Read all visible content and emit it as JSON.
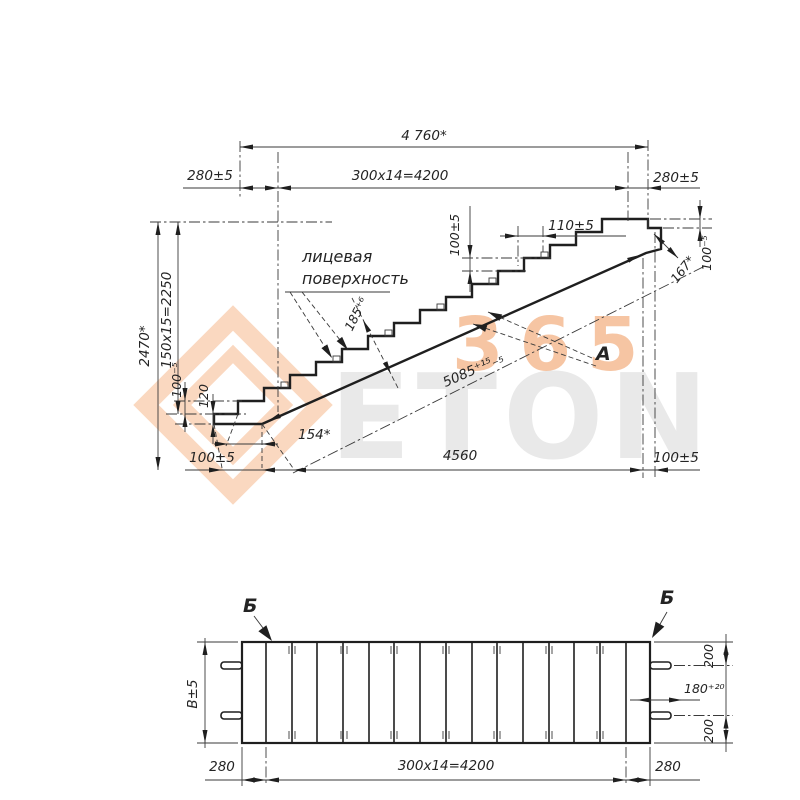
{
  "watermark": {
    "brand_letters": "ETON",
    "brand_digits": "365"
  },
  "elevation": {
    "overall_length": "4 760*",
    "left_end_width": "280±5",
    "treads_formula": "300x14=4200",
    "right_end_width": "280±5",
    "overall_height": "2470*",
    "risers_formula": "150x15=2250",
    "lower_step_height": "100⁻⁵",
    "lower_end_thickness": "120",
    "lower_bearing": "100±5",
    "nose_offset": "154*",
    "clear_span": "4560",
    "upper_bearing": "100±5",
    "riser_dim": "100±5",
    "tread_dim": "110±5",
    "slab_thickness": "185⁺⁶",
    "slope_length": "5085⁺¹⁵₋₅",
    "upper_notch_cut": "167*",
    "upper_notch_height": "100⁻⁵",
    "face_note_line1": "лицевая",
    "face_note_line2": "поверхность",
    "view_label": "А"
  },
  "plan": {
    "section_label_left": "Б",
    "section_label_right": "Б",
    "width_dim": "В±5",
    "lug_offset_top": "200",
    "lug_spacing": "180⁺²⁰",
    "lug_offset_bottom": "200",
    "left_end_width": "280",
    "treads_formula": "300x14=4200",
    "right_end_width": "280"
  }
}
